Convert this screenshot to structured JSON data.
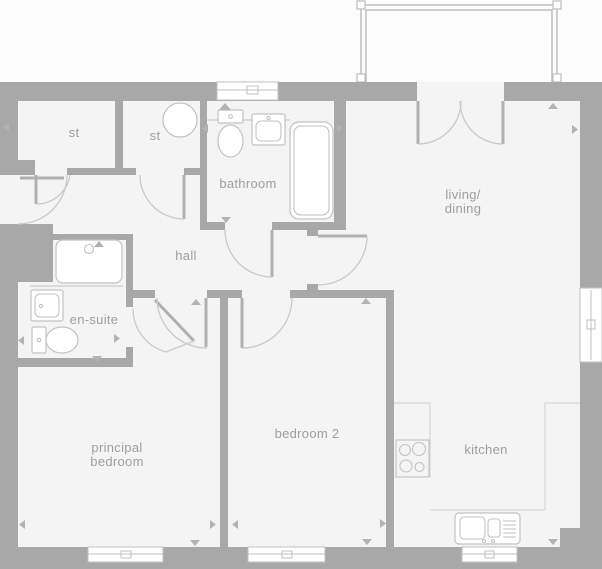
{
  "colors": {
    "background": "#fcfcfc",
    "floor": "#f4f4f4",
    "wall": "#a8a8a8",
    "door_arc": "#c9c9c9",
    "door_leaf": "#b0b0b0",
    "fixture": "#c2c2c2",
    "counter": "#cfcfcf",
    "window_frame": "#c0c0c0",
    "balcony": "#bdbdbd",
    "marker": "#b2b2b2",
    "label_text": "#9e9e9e"
  },
  "rooms": {
    "st1": {
      "label": "st"
    },
    "st2": {
      "label": "st"
    },
    "bathroom": {
      "label": "bathroom"
    },
    "hall": {
      "label": "hall"
    },
    "ensuite": {
      "label": "en-suite"
    },
    "living_dining": {
      "line1": "living/",
      "line2": "dining"
    },
    "principal_bedroom": {
      "line1": "principal",
      "line2": "bedroom"
    },
    "bedroom2": {
      "label": "bedroom 2"
    },
    "kitchen": {
      "label": "kitchen"
    }
  }
}
